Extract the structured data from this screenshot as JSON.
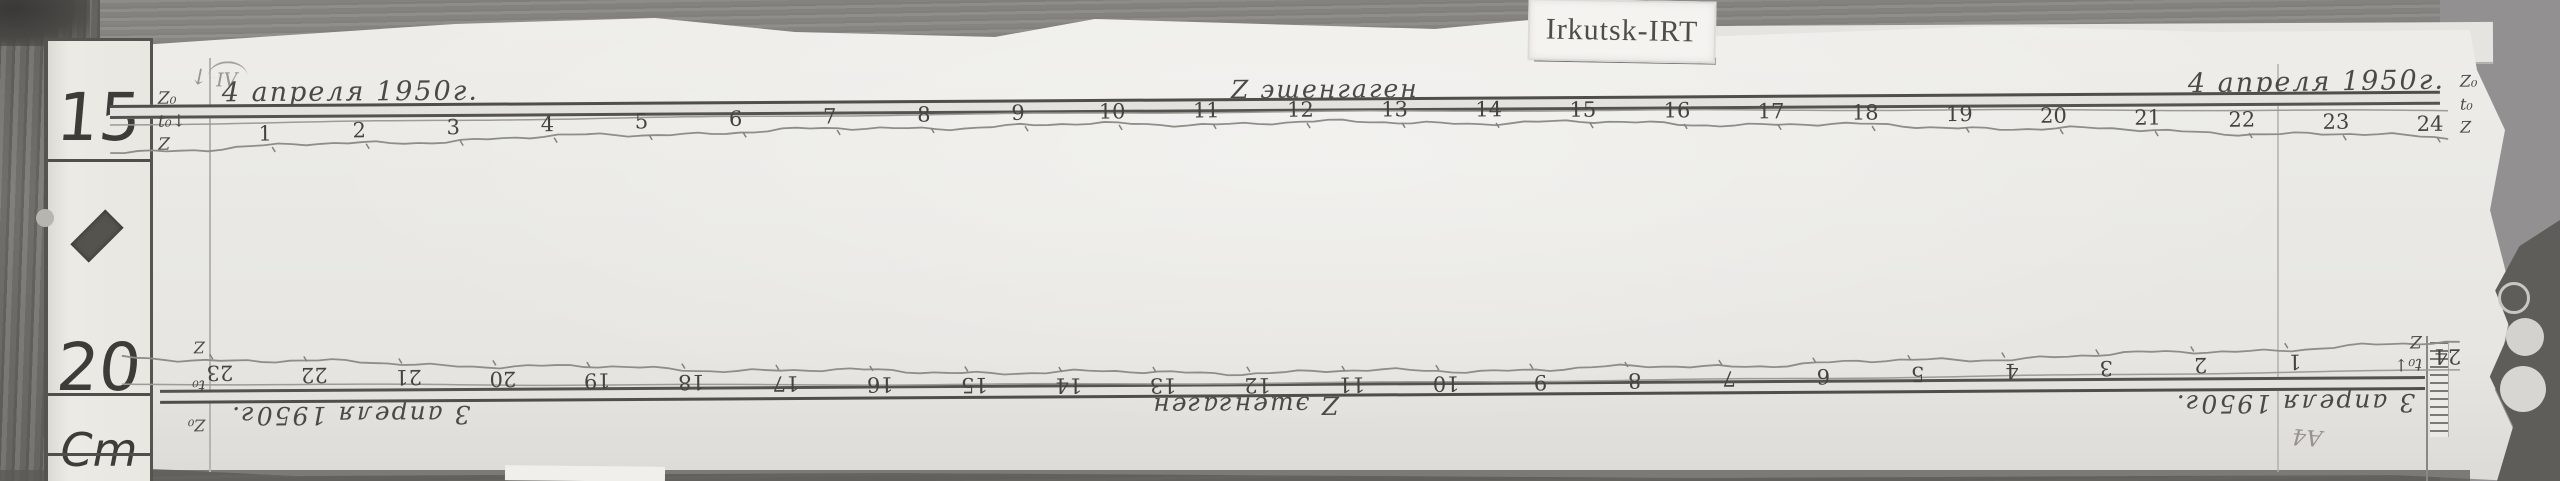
{
  "scene": {
    "label_card": "Irkutsk-IRT",
    "ruler": {
      "mark_15": "15",
      "mark_20": "20",
      "unit": "Cm"
    },
    "pencil_roman": "IV",
    "pencil_note": "А4"
  },
  "top_strip": {
    "date_left": "4 апреля 1950г.",
    "title": "Z эшенгаген",
    "date_right": "4 апреля 1950г.",
    "margin_left": [
      "Z₀",
      "t₀↓",
      "Z"
    ],
    "margin_right": [
      "Z₀",
      "t₀",
      "Z"
    ],
    "hours": [
      "1",
      "2",
      "3",
      "4",
      "5",
      "6",
      "7",
      "8",
      "9",
      "10",
      "11",
      "12",
      "13",
      "14",
      "15",
      "16",
      "17",
      "18",
      "19",
      "20",
      "21",
      "22",
      "23",
      "24"
    ]
  },
  "bottom_strip": {
    "date_left": "3 апреля 1950г.",
    "title": "Z эшенгаген",
    "date_right": "3 апреля 1950г.",
    "margin_left": [
      "t₀↓",
      "Z"
    ],
    "margin_right": [
      "Z₀",
      "t₀",
      "Z"
    ],
    "wrap_hour": "24",
    "hours": [
      "1",
      "2",
      "3",
      "4",
      "5",
      "6",
      "7",
      "8",
      "9",
      "10",
      "11",
      "12",
      "13",
      "14",
      "15",
      "16",
      "17",
      "18",
      "19",
      "20",
      "21",
      "22",
      "23"
    ]
  },
  "colors": {
    "paper": "#e9e8e4",
    "ink": "#4b4945",
    "trace": "#8f8d88",
    "wood": "#8f8d89"
  }
}
